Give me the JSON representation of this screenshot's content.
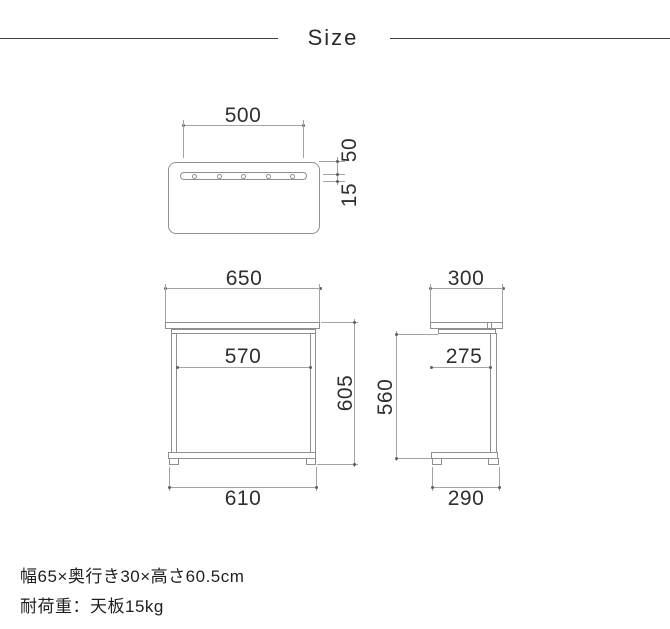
{
  "title": "Size",
  "views": {
    "top": {
      "slot_width": "500",
      "slot_back_offset": "50",
      "slot_depth": "15"
    },
    "front": {
      "top_width": "650",
      "inner_width": "570",
      "overall_height": "605",
      "base_width": "610"
    },
    "side": {
      "top_depth": "300",
      "inner_depth": "275",
      "inner_height": "560",
      "base_depth": "290"
    }
  },
  "footer": {
    "size_text": "幅65×奥行き30×高さ60.5cm",
    "load_text": "耐荷重：天板15kg"
  },
  "colors": {
    "outline": "#8f8f8f",
    "dim_line": "#a3a3a3",
    "dim_text": "#2f2f2f",
    "title_text": "#2a2a2a",
    "rule": "#3f3f3f",
    "footer_text": "#1f1f1f",
    "dot": "#606060",
    "bg": "#ffffff"
  }
}
